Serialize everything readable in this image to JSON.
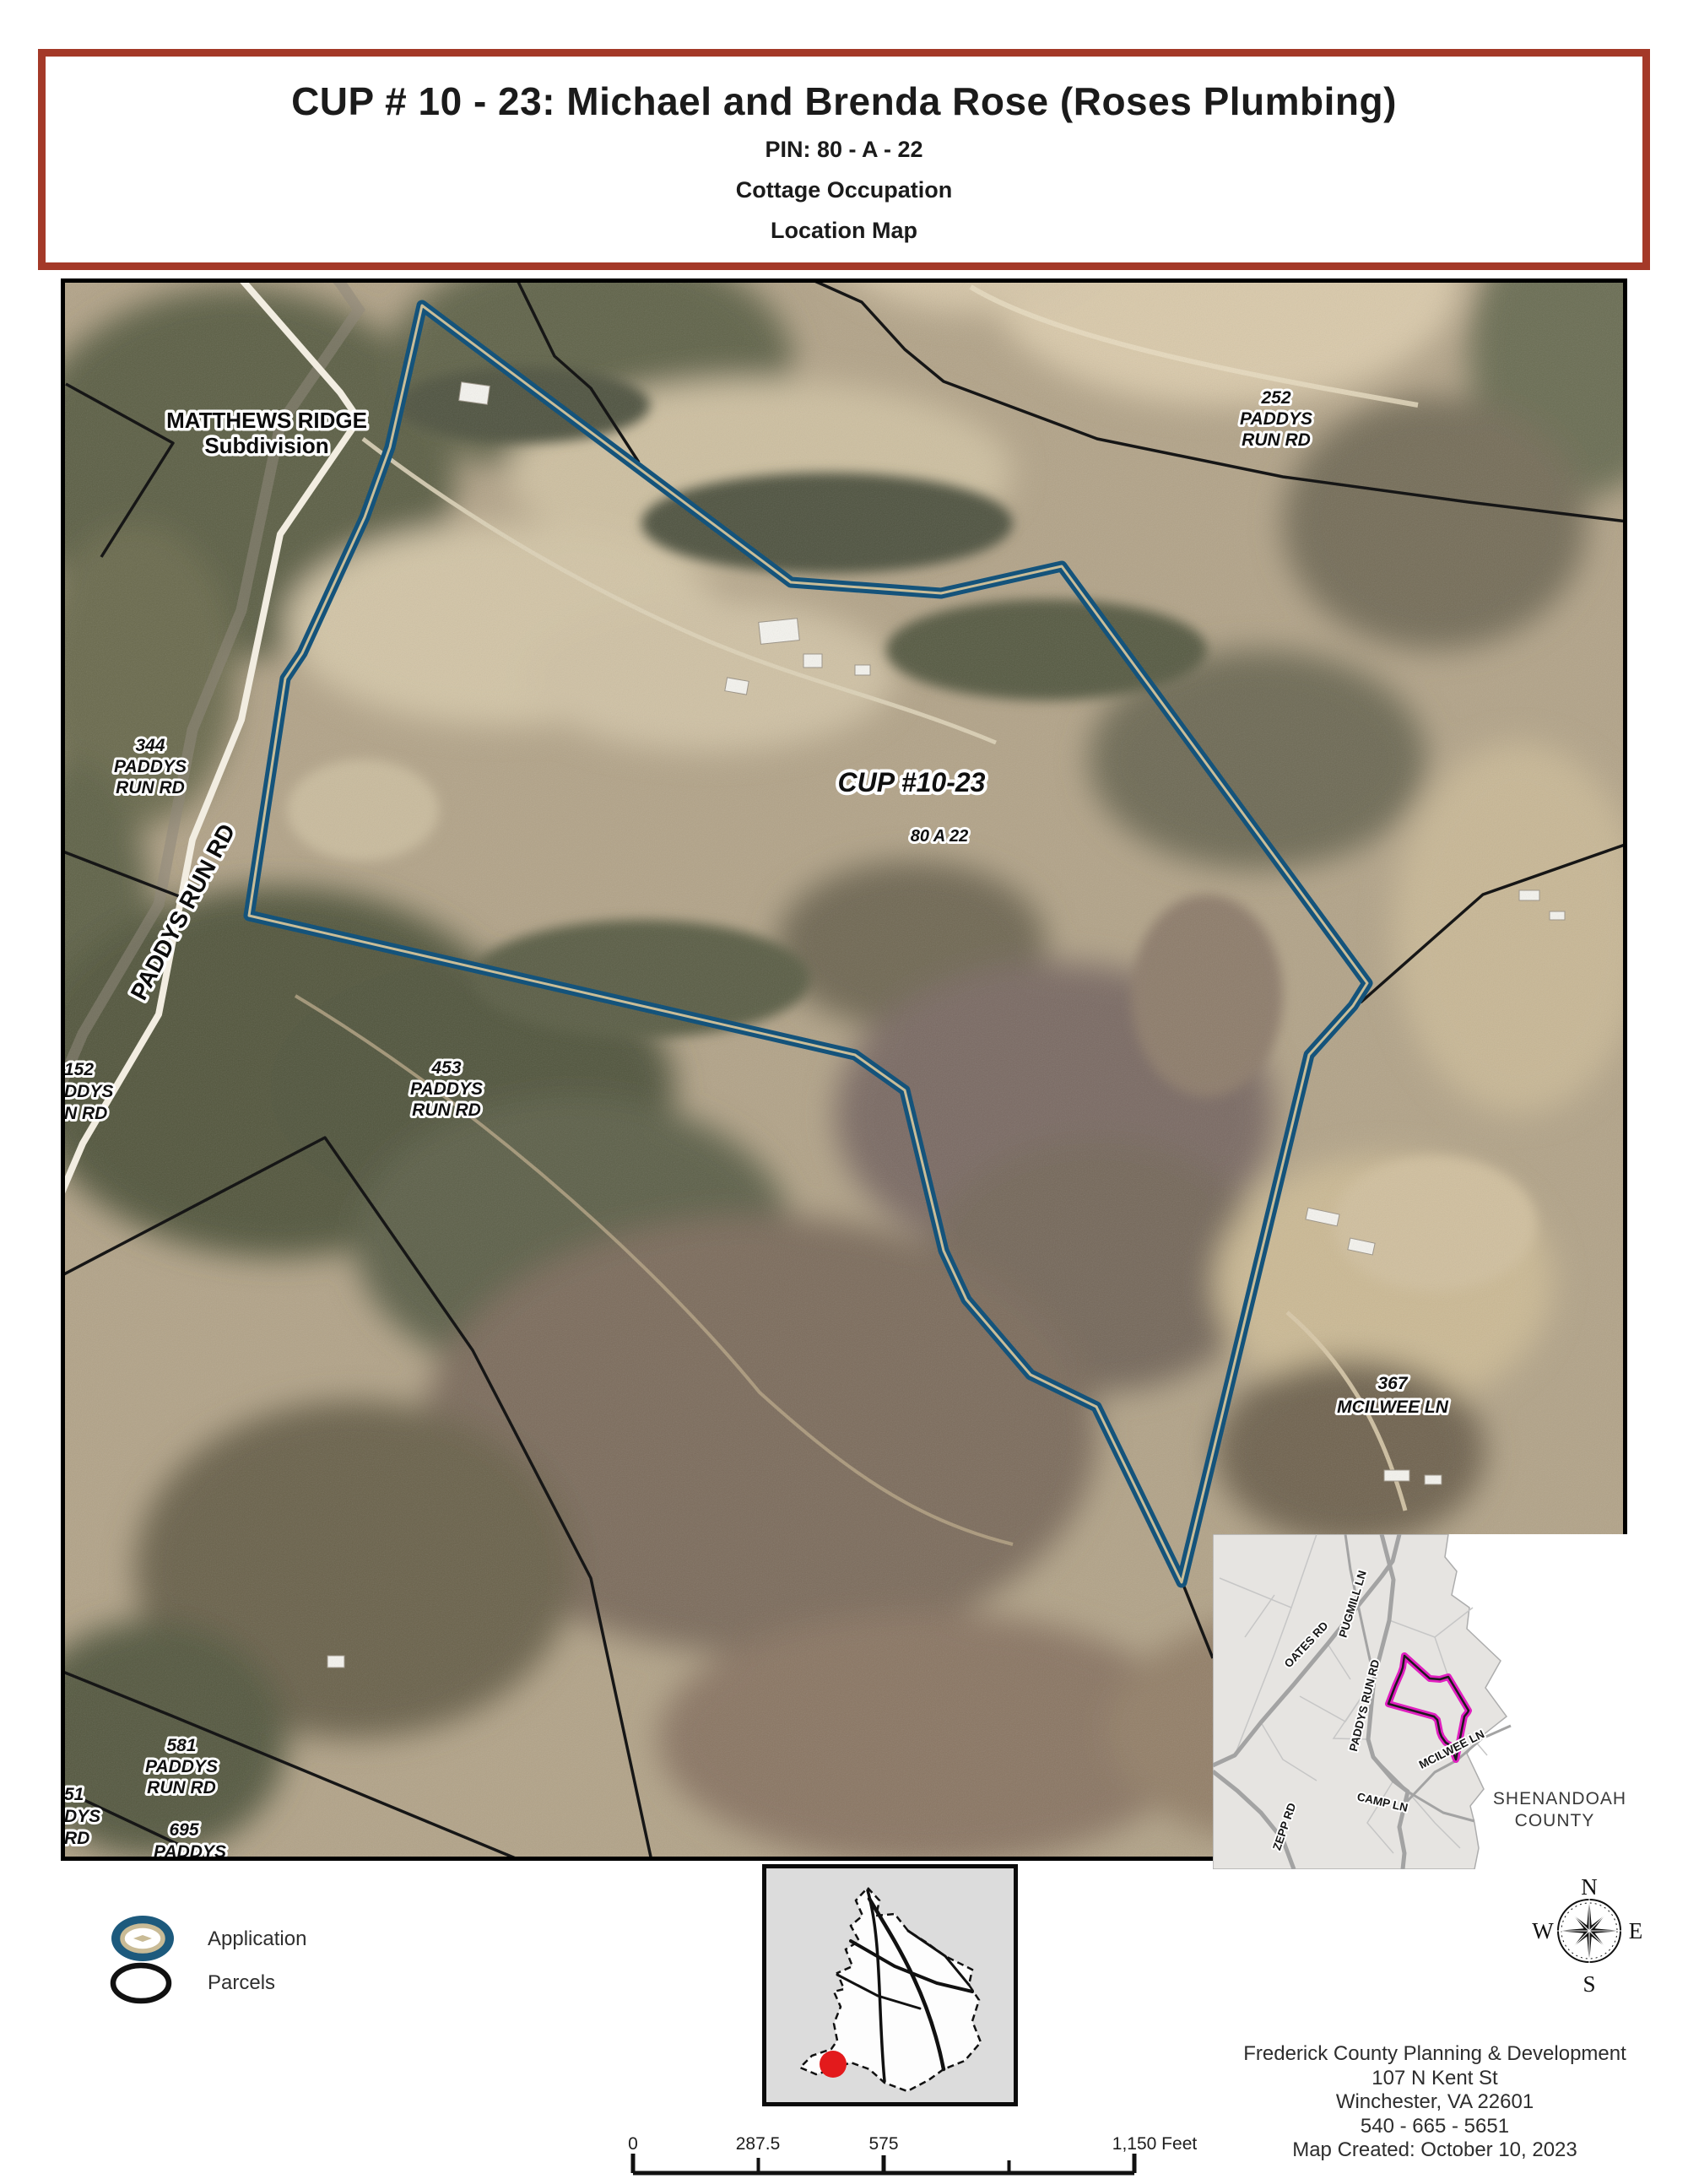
{
  "title_block": {
    "line1": "CUP # 10 - 23: Michael and Brenda Rose (Roses Plumbing)",
    "line2": "PIN: 80 - A - 22",
    "line3": "Cottage Occupation",
    "line4": "Location Map"
  },
  "map_labels": {
    "matthews": {
      "lines": [
        "MATTHEWS RIDGE",
        "Subdivision"
      ]
    },
    "addr252": {
      "lines": [
        "252",
        "PADDYS",
        "RUN RD"
      ]
    },
    "addr344": {
      "lines": [
        "344",
        "PADDYS",
        "RUN RD"
      ]
    },
    "cup": "CUP #10-23",
    "pin": "80 A 22",
    "addr453": {
      "lines": [
        "453",
        "PADDYS",
        "RUN RD"
      ]
    },
    "addr367": {
      "lines": [
        "367",
        "MCILWEE LN"
      ]
    },
    "addr581": {
      "lines": [
        "581",
        "PADDYS",
        "RUN RD"
      ]
    },
    "addr152": {
      "lines": [
        "152",
        "DDYS",
        "N RD"
      ]
    },
    "addr51": {
      "lines": [
        "51",
        "DYS",
        "RD"
      ]
    },
    "addr695": {
      "lines": [
        "695",
        "PADDYS"
      ]
    },
    "road": "PADDYS RUN RD"
  },
  "inset_shenandoah": {
    "roads": [
      "OATES RD",
      "PUGMILL LN",
      "PADDYS RUN RD",
      "MCILWEE LN",
      "CAMP LN",
      "ZEPP RD"
    ],
    "county": {
      "lines": [
        "SHENANDOAH",
        "COUNTY"
      ]
    }
  },
  "legend": {
    "application": "Application",
    "parcels": "Parcels"
  },
  "compass": {
    "n": "N",
    "e": "E",
    "s": "S",
    "w": "W"
  },
  "scale_bar": {
    "t0": "0",
    "t1": "287.5",
    "t2": "575",
    "t3": "1,150 Feet"
  },
  "footer": {
    "line1": "Frederick County Planning & Development",
    "line2": "107 N Kent St",
    "line3": "Winchester, VA 22601",
    "line4": "540 - 665 - 5651",
    "line5": "Map Created: October 10, 2023"
  },
  "colors": {
    "title_border": "#a43928",
    "application_outline": "#14537b",
    "application_core": "#c9bd98",
    "parcel_line": "#161616",
    "inset_parcel": "#e01fc0",
    "locator_dot": "#e31a1c"
  }
}
